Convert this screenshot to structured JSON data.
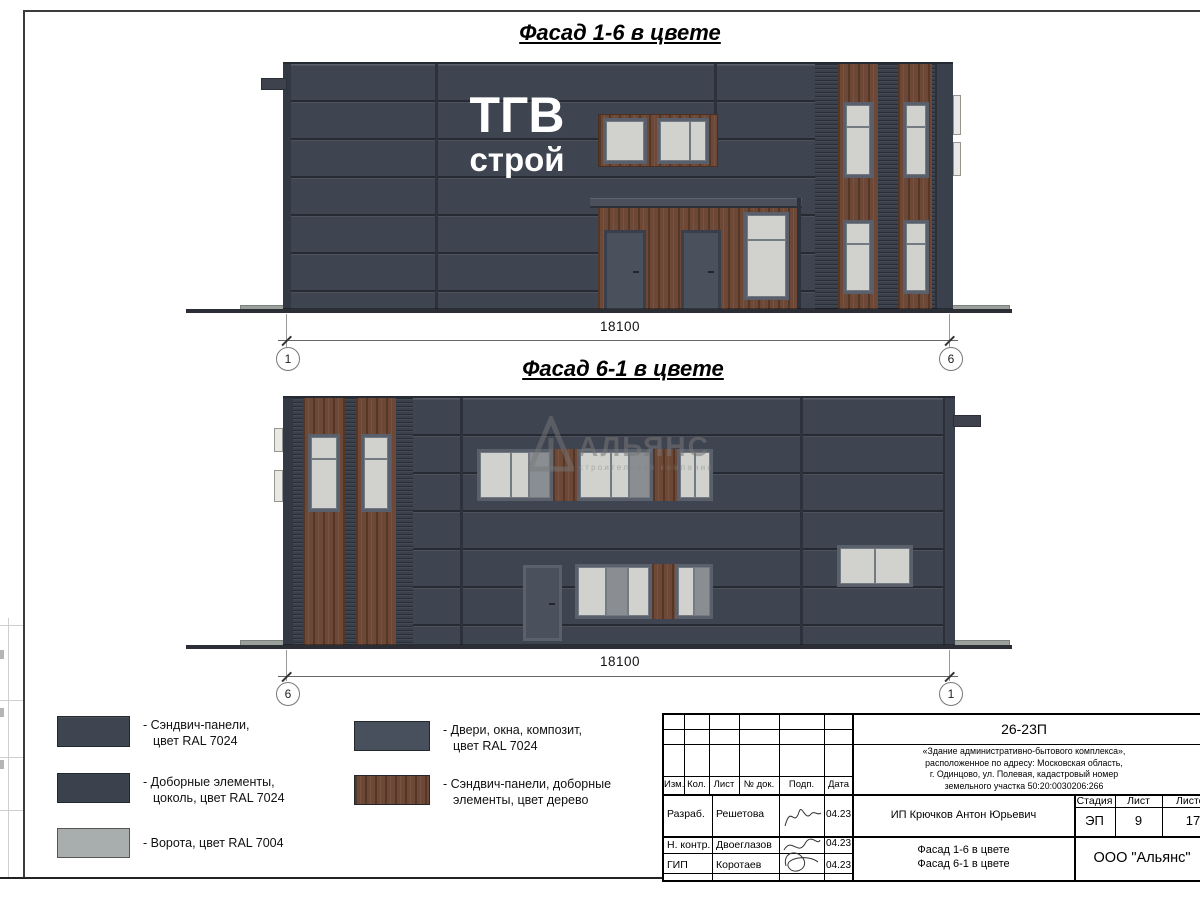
{
  "facade1": {
    "title": "Фасад 1-6 в цвете",
    "logo_line1": "ТГВ",
    "logo_line2": "строй",
    "dimension": "18100",
    "axis_left": "1",
    "axis_right": "6"
  },
  "facade2": {
    "title": "Фасад 6-1 в цвете",
    "dimension": "18100",
    "axis_left": "6",
    "axis_right": "1",
    "watermark_name": "АЛЬЯНС",
    "watermark_subtitle": "строительная компания"
  },
  "legend": [
    {
      "label": "- Сэндвич-панели,\nцвет RAL 7024",
      "color": "#3e4450"
    },
    {
      "label": "- Доборные элементы,\nцоколь, цвет RAL 7024",
      "color": "#3c424d"
    },
    {
      "label": "- Ворота, цвет RAL 7004",
      "color": "#a8adad"
    },
    {
      "label": "- Двери, окна, композит,\nцвет RAL 7024",
      "color": "#47505c"
    },
    {
      "label": "- Сэндвич-панели, доборные\nэлементы, цвет дерево",
      "color": "#6d4836"
    }
  ],
  "titleblock": {
    "code": "26-23П",
    "description": "«Здание административно-бытового комплекса»,\nрасположенное по адресу: Московская область,\nг. Одинцово, ул. Полевая, кадастровый номер\nземельного участка 50:20:0030206:266",
    "headers": {
      "izm": "Изм.",
      "kol": "Кол.",
      "list": "Лист",
      "doc": "№ док.",
      "podp": "Подп.",
      "data": "Дата"
    },
    "rows": [
      {
        "role": "Разраб.",
        "name": "Решетова",
        "date": "04.23"
      },
      {
        "role": "Н. контр.",
        "name": "Двоеглазов",
        "date": "04.23"
      },
      {
        "role": "ГИП",
        "name": "Коротаев",
        "date": "04.23"
      }
    ],
    "client": "ИП Крючков Антон Юрьевич",
    "stage_label": "Стадия",
    "sheet_label": "Лист",
    "sheets_label": "Листов",
    "stage": "ЭП",
    "sheet_num": "9",
    "sheets_total": "17",
    "drawing_title": "Фасад 1-6 в цвете\nФасад 6-1 в цвете",
    "company": "ООО \"Альянс\""
  },
  "colors": {
    "facade_ral7024": "#3e4450",
    "gate_ral7004": "#a8adad",
    "wood": "#6d4836",
    "glass": "#cfcfcc",
    "window_frame": "#59606b"
  }
}
